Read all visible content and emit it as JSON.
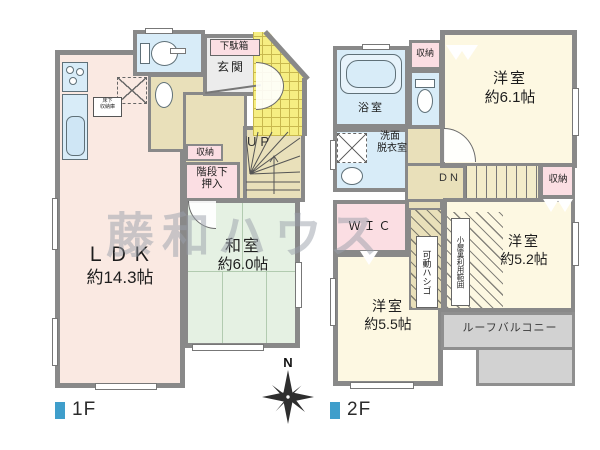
{
  "watermark": "藤和ハウス",
  "compass": {
    "north": "N"
  },
  "f1": {
    "legend": "1F",
    "ldk_name": "ＬＤＫ",
    "ldk_size": "約14.3帖",
    "washitsu_name": "和室",
    "washitsu_size": "約6.0帖",
    "genkan": "玄関",
    "getabako": "下駄箱",
    "shuno": "収納",
    "kaidan_line1": "階段下",
    "kaidan_line2": "押入",
    "up": "UP",
    "yukashita_line1": "床下",
    "yukashita_line2": "収納庫"
  },
  "f2": {
    "legend": "2F",
    "bath": "浴室",
    "senmen_line1": "洗面",
    "senmen_line2": "脱衣室",
    "shuno_a": "収納",
    "shuno_b": "収納",
    "dn": "DN",
    "wic": "ＷＩＣ",
    "room61_name": "洋室",
    "room61_size": "約6.1帖",
    "room52_name": "洋室",
    "room52_size": "約5.2帖",
    "room55_name": "洋室",
    "room55_size": "約5.5帖",
    "ladder": "可動ハシゴ",
    "attic": "小屋裏利用範囲",
    "balcony": "ルーフバルコニー"
  },
  "colors": {
    "accent_blue": "#3f9ecb",
    "wall_gray": "#898989",
    "ldk_peach": "#fae9e2",
    "tatami_green": "#e5f1e3",
    "water_blue": "#d8ecf8",
    "closet_pink": "#fbdee3",
    "hall_tan": "#e9e0ba",
    "room_cream": "#fdf8e2",
    "porch_yellow": "#f6ee82",
    "balcony_gray": "#d2d2d2"
  }
}
